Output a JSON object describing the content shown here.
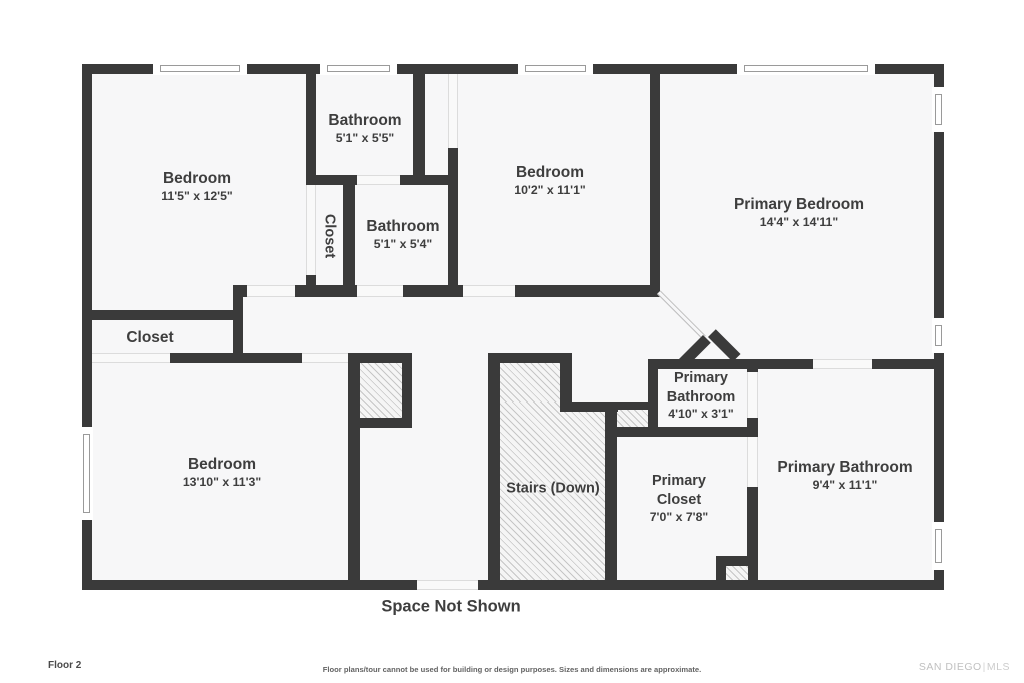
{
  "floorplan": {
    "rooms": [
      {
        "id": "bedroom-top-left",
        "name": "Bedroom",
        "dims": "11'5\" x 12'5\""
      },
      {
        "id": "bathroom-top",
        "name": "Bathroom",
        "dims": "5'1\" x 5'5\""
      },
      {
        "id": "bathroom-mid",
        "name": "Bathroom",
        "dims": "5'1\" x 5'4\""
      },
      {
        "id": "bedroom-mid",
        "name": "Bedroom",
        "dims": "10'2\" x 11'1\""
      },
      {
        "id": "primary-bedroom",
        "name": "Primary Bedroom",
        "dims": "14'4\" x 14'11\""
      },
      {
        "id": "closet-vertical",
        "name": "Closet"
      },
      {
        "id": "closet-left",
        "name": "Closet"
      },
      {
        "id": "bedroom-bottom-left",
        "name": "Bedroom",
        "dims": "13'10\" x 11'3\""
      },
      {
        "id": "stairs",
        "name": "Stairs (Down)"
      },
      {
        "id": "primary-bathroom-small",
        "name": "Primary Bathroom",
        "dims": "4'10\" x 3'1\""
      },
      {
        "id": "primary-closet",
        "name": "Primary Closet",
        "dims": "7'0\" x 7'8\""
      },
      {
        "id": "primary-bathroom",
        "name": "Primary Bathroom",
        "dims": "9'4\" x 11'1\""
      }
    ],
    "annotations": {
      "space_not_shown": "Space Not Shown"
    },
    "footer": {
      "floor_label": "Floor 2",
      "disclaimer": "Floor plans/tour cannot be used for building or design purposes. Sizes and dimensions are approximate.",
      "brand": "SAN DIEGO",
      "brand_separator": "|",
      "brand_suffix": "MLS"
    },
    "colors": {
      "wall": "#3a3a3a",
      "floor": "#f7f7f8",
      "text": "#3e3e3e",
      "hatch_line": "#c6c6c6",
      "window_line": "#9a9a9a",
      "opening_line": "#dcdcdc",
      "brand_text": "#c0c0c0"
    }
  }
}
